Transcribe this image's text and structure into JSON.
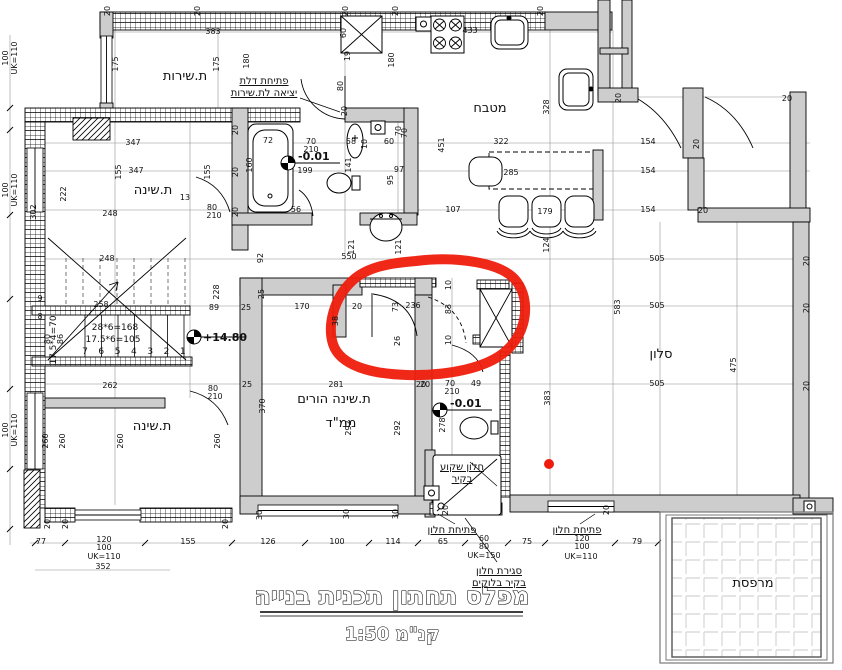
{
  "title": {
    "main": "מפלס תחתון תכנית בנייה",
    "scale": "קנ\"מ 1:50"
  },
  "rooms": [
    {
      "id": "service-room",
      "label": "ת.שירות",
      "x": 185,
      "y": 80,
      "size": 13
    },
    {
      "id": "kitchen",
      "label": "מטבח",
      "x": 490,
      "y": 112,
      "size": 13
    },
    {
      "id": "bedroom-top",
      "label": "ת.שינה",
      "x": 153,
      "y": 194,
      "size": 13
    },
    {
      "id": "bedroom-bottom",
      "label": "ת.שינה",
      "x": 152,
      "y": 430,
      "size": 13
    },
    {
      "id": "parents-bedroom",
      "label": "ת.שינה הורים",
      "x": 334,
      "y": 403,
      "size": 12
    },
    {
      "id": "mamad",
      "label": "ממ\"ד",
      "x": 341,
      "y": 427,
      "size": 12
    },
    {
      "id": "living-room",
      "label": "סלון",
      "x": 661,
      "y": 358,
      "size": 13
    },
    {
      "id": "balcony",
      "label": "מרפסת",
      "x": 753,
      "y": 587,
      "size": 12
    }
  ],
  "annotations": [
    {
      "name": "door-note-service",
      "lines": [
        "פתיחת דלת",
        "יציאה לת.שירות"
      ],
      "x": 264,
      "y": 84
    },
    {
      "name": "window-note-left",
      "lines": [
        "פתיחת חלון"
      ],
      "x": 452,
      "y": 533
    },
    {
      "name": "window-note-right",
      "lines": [
        "פתיחת חלון"
      ],
      "x": 577,
      "y": 533
    },
    {
      "name": "recessed-window-note",
      "lines": [
        "חלון שקוע",
        "בקיר"
      ],
      "x": 462,
      "y": 470
    },
    {
      "name": "window-closure-note",
      "lines": [
        "סגירת חלון",
        "בקיר בלוקים"
      ],
      "x": 499,
      "y": 574
    }
  ],
  "levels": [
    {
      "label": "-0.01",
      "sx": 288,
      "sy": 163,
      "tx": 298,
      "ty": 160
    },
    {
      "label": "-0.01",
      "sx": 440,
      "sy": 410,
      "tx": 450,
      "ty": 407
    },
    {
      "label": "+14.80",
      "sx": 194,
      "sy": 337,
      "tx": 203,
      "ty": 341
    }
  ],
  "stairs": {
    "formulas": [
      "28*6=168",
      "17.5*6=105"
    ],
    "side_formula": "17.5*4=70",
    "step_numbers": [
      "7",
      "6",
      "5",
      "4",
      "3",
      "2",
      "1"
    ]
  },
  "red_marks": {
    "color": "#ee1c0c",
    "dot": {
      "cx": 549,
      "cy": 464,
      "r": 5
    }
  },
  "dimensions": [
    {
      "t": "20",
      "x": 110,
      "y": 11,
      "r": 1
    },
    {
      "t": "20",
      "x": 200,
      "y": 11,
      "r": 1
    },
    {
      "t": "383",
      "x": 213,
      "y": 34
    },
    {
      "t": "20",
      "x": 348,
      "y": 11,
      "r": 1
    },
    {
      "t": "20",
      "x": 398,
      "y": 11,
      "r": 1
    },
    {
      "t": "20",
      "x": 543,
      "y": 11,
      "r": 1
    },
    {
      "t": "100",
      "x": 8,
      "y": 58,
      "r": 1
    },
    {
      "t": "UK=110",
      "x": 17,
      "y": 58,
      "r": 1
    },
    {
      "t": "100",
      "x": 8,
      "y": 190,
      "r": 1
    },
    {
      "t": "UK=110",
      "x": 17,
      "y": 190,
      "r": 1
    },
    {
      "t": "100",
      "x": 8,
      "y": 430,
      "r": 1
    },
    {
      "t": "UK=110",
      "x": 17,
      "y": 430,
      "r": 1
    },
    {
      "t": "175",
      "x": 118,
      "y": 64,
      "r": 1
    },
    {
      "t": "175",
      "x": 219,
      "y": 64,
      "r": 1
    },
    {
      "t": "180",
      "x": 249,
      "y": 61,
      "r": 1
    },
    {
      "t": "60",
      "x": 346,
      "y": 33,
      "r": 1
    },
    {
      "t": "19",
      "x": 350,
      "y": 56,
      "r": 1
    },
    {
      "t": "80",
      "x": 343,
      "y": 86,
      "r": 1
    },
    {
      "t": "20",
      "x": 347,
      "y": 111,
      "r": 1
    },
    {
      "t": "180",
      "x": 394,
      "y": 60,
      "r": 1
    },
    {
      "t": "433",
      "x": 470,
      "y": 33
    },
    {
      "t": "328",
      "x": 549,
      "y": 107,
      "r": 1
    },
    {
      "t": "70",
      "x": 401,
      "y": 131,
      "r": 1
    },
    {
      "t": "322",
      "x": 501,
      "y": 144
    },
    {
      "t": "451",
      "x": 444,
      "y": 145,
      "r": 1
    },
    {
      "t": "285",
      "x": 511,
      "y": 175
    },
    {
      "t": "107",
      "x": 453,
      "y": 212
    },
    {
      "t": "179",
      "x": 545,
      "y": 214
    },
    {
      "t": "124",
      "x": 549,
      "y": 245,
      "r": 1
    },
    {
      "t": "154",
      "x": 648,
      "y": 144
    },
    {
      "t": "154",
      "x": 648,
      "y": 173
    },
    {
      "t": "154",
      "x": 648,
      "y": 212
    },
    {
      "t": "20",
      "x": 699,
      "y": 144,
      "r": 1
    },
    {
      "t": "20",
      "x": 621,
      "y": 98,
      "r": 1
    },
    {
      "t": "20",
      "x": 703,
      "y": 213
    },
    {
      "t": "20",
      "x": 787,
      "y": 101
    },
    {
      "t": "347",
      "x": 133,
      "y": 145
    },
    {
      "t": "347",
      "x": 136,
      "y": 173
    },
    {
      "t": "155",
      "x": 121,
      "y": 172,
      "r": 1
    },
    {
      "t": "155",
      "x": 210,
      "y": 172,
      "r": 1
    },
    {
      "t": "222",
      "x": 66,
      "y": 194,
      "r": 1
    },
    {
      "t": "302",
      "x": 36,
      "y": 212,
      "r": 1
    },
    {
      "t": "248",
      "x": 110,
      "y": 216
    },
    {
      "t": "13",
      "x": 185,
      "y": 200
    },
    {
      "t": "80",
      "x": 212,
      "y": 210
    },
    {
      "t": "210",
      "x": 214,
      "y": 218
    },
    {
      "t": "248",
      "x": 107,
      "y": 261
    },
    {
      "t": "258",
      "x": 101,
      "y": 307
    },
    {
      "t": "89",
      "x": 214,
      "y": 310
    },
    {
      "t": "9",
      "x": 40,
      "y": 301
    },
    {
      "t": "8",
      "x": 40,
      "y": 319
    },
    {
      "t": "80",
      "x": 50,
      "y": 339,
      "r": 1
    },
    {
      "t": "86",
      "x": 63,
      "y": 339,
      "r": 1
    },
    {
      "t": "262",
      "x": 110,
      "y": 388
    },
    {
      "t": "80",
      "x": 213,
      "y": 391
    },
    {
      "t": "210",
      "x": 215,
      "y": 399
    },
    {
      "t": "92",
      "x": 263,
      "y": 258,
      "r": 1
    },
    {
      "t": "550",
      "x": 349,
      "y": 259
    },
    {
      "t": "228",
      "x": 219,
      "y": 292,
      "r": 1
    },
    {
      "t": "25",
      "x": 246,
      "y": 310
    },
    {
      "t": "170",
      "x": 302,
      "y": 309
    },
    {
      "t": "25",
      "x": 264,
      "y": 294,
      "r": 1
    },
    {
      "t": "20",
      "x": 357,
      "y": 309
    },
    {
      "t": "73",
      "x": 398,
      "y": 307,
      "r": 1
    },
    {
      "t": "236",
      "x": 413,
      "y": 308
    },
    {
      "t": "83",
      "x": 451,
      "y": 309,
      "r": 1
    },
    {
      "t": "10",
      "x": 451,
      "y": 285,
      "r": 1
    },
    {
      "t": "10",
      "x": 451,
      "y": 340,
      "r": 1
    },
    {
      "t": "26",
      "x": 400,
      "y": 341,
      "r": 1
    },
    {
      "t": "38",
      "x": 338,
      "y": 321,
      "r": 1
    },
    {
      "t": "72",
      "x": 268,
      "y": 143
    },
    {
      "t": "160",
      "x": 252,
      "y": 165,
      "r": 1
    },
    {
      "t": "70",
      "x": 311,
      "y": 144
    },
    {
      "t": "210",
      "x": 311,
      "y": 152
    },
    {
      "t": "199",
      "x": 305,
      "y": 173
    },
    {
      "t": "58",
      "x": 351,
      "y": 144
    },
    {
      "t": "10",
      "x": 367,
      "y": 144,
      "r": 1
    },
    {
      "t": "60",
      "x": 389,
      "y": 144
    },
    {
      "t": "70",
      "x": 407,
      "y": 133,
      "r": 1
    },
    {
      "t": "141",
      "x": 351,
      "y": 165,
      "r": 1
    },
    {
      "t": "97",
      "x": 399,
      "y": 172
    },
    {
      "t": "95",
      "x": 393,
      "y": 180,
      "r": 1
    },
    {
      "t": "121",
      "x": 354,
      "y": 247,
      "r": 1
    },
    {
      "t": "121",
      "x": 401,
      "y": 247,
      "r": 1
    },
    {
      "t": "56",
      "x": 296,
      "y": 212
    },
    {
      "t": "20",
      "x": 238,
      "y": 130,
      "r": 1
    },
    {
      "t": "20",
      "x": 238,
      "y": 172,
      "r": 1
    },
    {
      "t": "20",
      "x": 238,
      "y": 212,
      "r": 1
    },
    {
      "t": "25",
      "x": 247,
      "y": 387
    },
    {
      "t": "281",
      "x": 336,
      "y": 387
    },
    {
      "t": "20",
      "x": 421,
      "y": 387
    },
    {
      "t": "370",
      "x": 265,
      "y": 406,
      "r": 1
    },
    {
      "t": "292",
      "x": 351,
      "y": 428,
      "r": 1
    },
    {
      "t": "292",
      "x": 400,
      "y": 428,
      "r": 1
    },
    {
      "t": "30",
      "x": 262,
      "y": 515,
      "r": 1
    },
    {
      "t": "30",
      "x": 349,
      "y": 514,
      "r": 1
    },
    {
      "t": "30",
      "x": 398,
      "y": 514,
      "r": 1
    },
    {
      "t": "20",
      "x": 425,
      "y": 387
    },
    {
      "t": "70",
      "x": 450,
      "y": 386
    },
    {
      "t": "210",
      "x": 452,
      "y": 394
    },
    {
      "t": "49",
      "x": 476,
      "y": 386
    },
    {
      "t": "278",
      "x": 445,
      "y": 425,
      "r": 1
    },
    {
      "t": "383",
      "x": 550,
      "y": 398,
      "r": 1
    },
    {
      "t": "260",
      "x": 48,
      "y": 441,
      "r": 1
    },
    {
      "t": "260",
      "x": 65,
      "y": 441,
      "r": 1
    },
    {
      "t": "260",
      "x": 123,
      "y": 441,
      "r": 1
    },
    {
      "t": "260",
      "x": 220,
      "y": 441,
      "r": 1
    },
    {
      "t": "505",
      "x": 657,
      "y": 261
    },
    {
      "t": "505",
      "x": 657,
      "y": 308
    },
    {
      "t": "505",
      "x": 657,
      "y": 386
    },
    {
      "t": "583",
      "x": 620,
      "y": 307,
      "r": 1
    },
    {
      "t": "475",
      "x": 736,
      "y": 365,
      "r": 1
    },
    {
      "t": "20",
      "x": 809,
      "y": 261,
      "r": 1
    },
    {
      "t": "20",
      "x": 809,
      "y": 308,
      "r": 1
    },
    {
      "t": "20",
      "x": 809,
      "y": 386,
      "r": 1
    },
    {
      "t": "77",
      "x": 41,
      "y": 544
    },
    {
      "t": "120",
      "x": 104,
      "y": 542
    },
    {
      "t": "100",
      "x": 104,
      "y": 550
    },
    {
      "t": "UK=110",
      "x": 104,
      "y": 559
    },
    {
      "t": "352",
      "x": 103,
      "y": 569
    },
    {
      "t": "155",
      "x": 188,
      "y": 544
    },
    {
      "t": "126",
      "x": 268,
      "y": 544
    },
    {
      "t": "100",
      "x": 337,
      "y": 544
    },
    {
      "t": "114",
      "x": 393,
      "y": 544
    },
    {
      "t": "65",
      "x": 443,
      "y": 544
    },
    {
      "t": "60",
      "x": 484,
      "y": 541
    },
    {
      "t": "80",
      "x": 484,
      "y": 549
    },
    {
      "t": "UK=150",
      "x": 484,
      "y": 558
    },
    {
      "t": "75",
      "x": 527,
      "y": 544
    },
    {
      "t": "120",
      "x": 582,
      "y": 541
    },
    {
      "t": "100",
      "x": 582,
      "y": 549
    },
    {
      "t": "UK=110",
      "x": 581,
      "y": 559
    },
    {
      "t": "79",
      "x": 637,
      "y": 544
    },
    {
      "t": "20",
      "x": 448,
      "y": 510,
      "r": 1
    },
    {
      "t": "20",
      "x": 609,
      "y": 510,
      "r": 1
    },
    {
      "t": "20",
      "x": 50,
      "y": 524,
      "r": 1
    },
    {
      "t": "20",
      "x": 68,
      "y": 524,
      "r": 1
    },
    {
      "t": "20",
      "x": 228,
      "y": 524,
      "r": 1
    }
  ]
}
